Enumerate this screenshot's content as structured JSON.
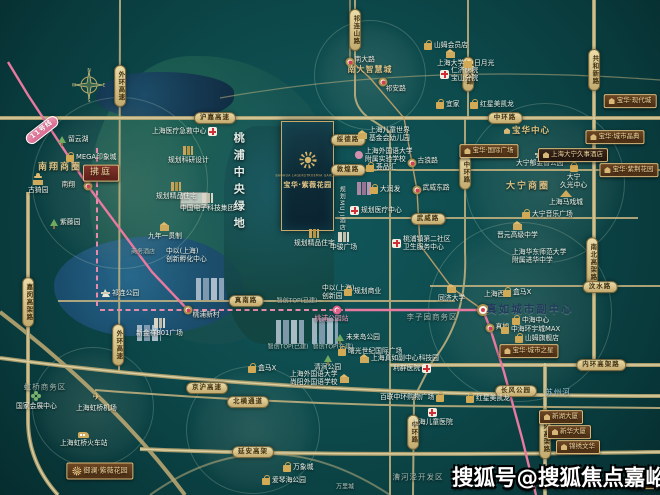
{
  "watermark": "搜狐号@搜狐焦点嘉峪关站",
  "project_card": {
    "name_en": "BAOHUA LAGERSTROEMIA GARDEN",
    "name_cn": "宝华·紫薇花园"
  },
  "compass": {
    "n": "N",
    "e": "E",
    "s": "S",
    "w": "W"
  },
  "colors": {
    "background_teal": "#0d4a4c",
    "road_tan": "#c7b480",
    "metro_pink": "#e8799f",
    "gold_accent": "#d4b36a",
    "banner_brown": "#5e3c1f",
    "watermark_white": "#ffffff"
  },
  "map": {
    "central_green_label": "桃浦中央绿地",
    "items": [
      {
        "t": "pill",
        "x": 215,
        "y": 118,
        "l": "沪嘉高速",
        "n": "road-hujia-expwy"
      },
      {
        "t": "pill",
        "x": 505,
        "y": 118,
        "l": "中环路",
        "n": "road-zhonghuan-top"
      },
      {
        "t": "pill",
        "x": 120,
        "y": 86,
        "l": "外环高速",
        "c": "vert",
        "n": "road-waihuan-north"
      },
      {
        "t": "pill",
        "x": 118,
        "y": 345,
        "l": "外环高速",
        "c": "vert",
        "n": "road-waihuan-south"
      },
      {
        "t": "pill",
        "x": 28,
        "y": 302,
        "l": "嘉闵高架路",
        "c": "vert",
        "n": "road-jiamin-elevated"
      },
      {
        "t": "pill",
        "x": 355,
        "y": 30,
        "l": "祁连山路",
        "c": "vert",
        "n": "road-qilianshan"
      },
      {
        "t": "pill",
        "x": 468,
        "y": 74,
        "l": "沪太路",
        "c": "vert",
        "n": "road-hutai"
      },
      {
        "t": "pill",
        "x": 594,
        "y": 70,
        "l": "共和新路",
        "c": "vert",
        "n": "road-gonghexin"
      },
      {
        "t": "pill",
        "x": 465,
        "y": 172,
        "l": "中环路",
        "c": "vert",
        "n": "road-zhonghuan-mid"
      },
      {
        "t": "pill",
        "x": 592,
        "y": 262,
        "l": "南北高架路",
        "c": "vert",
        "n": "road-nanbei-elevated"
      },
      {
        "t": "pill",
        "x": 348,
        "y": 140,
        "l": "绥德路",
        "n": "road-suide"
      },
      {
        "t": "pill",
        "x": 348,
        "y": 170,
        "l": "敦煌路",
        "n": "road-dunhuang"
      },
      {
        "t": "pill",
        "x": 428,
        "y": 219,
        "l": "武威路",
        "n": "road-wuwei"
      },
      {
        "t": "pill",
        "x": 600,
        "y": 287,
        "l": "汶水路",
        "n": "road-wenshui"
      },
      {
        "t": "pill",
        "x": 246,
        "y": 301,
        "l": "真南路",
        "n": "road-zhennan"
      },
      {
        "t": "pill",
        "x": 601,
        "y": 365,
        "l": "内环高架路",
        "n": "road-neihuan-horizontal"
      },
      {
        "t": "pill",
        "x": 207,
        "y": 388,
        "l": "京沪高速",
        "n": "road-jinghu-expwy"
      },
      {
        "t": "pill",
        "x": 248,
        "y": 402,
        "l": "北横通道",
        "n": "road-beiheng-tunnel"
      },
      {
        "t": "pill",
        "x": 253,
        "y": 452,
        "l": "延安高架",
        "n": "road-yanan-elevated"
      },
      {
        "t": "pill",
        "x": 413,
        "y": 432,
        "l": "中环路",
        "c": "vert",
        "n": "road-zhonghuan-south"
      },
      {
        "t": "pill",
        "x": 545,
        "y": 434,
        "l": "内环高架路",
        "c": "vert",
        "n": "road-neihuan-vertical"
      },
      {
        "t": "pill",
        "x": 516,
        "y": 391,
        "l": "长风公园",
        "n": "changfeng-park"
      },
      {
        "t": "pill",
        "x": 42,
        "y": 130,
        "l": "11号线",
        "c": "pink",
        "rot": -38,
        "n": "metro-line-11-label"
      },
      {
        "t": "sta",
        "x": 350,
        "y": 62,
        "l": "南大路",
        "dx": 7,
        "dy": -4,
        "n": "station-nandalu"
      },
      {
        "t": "sta",
        "x": 383,
        "y": 82,
        "l": "祁安路",
        "dx": 5,
        "dy": 5,
        "n": "station-qianlu"
      },
      {
        "t": "sta",
        "x": 412,
        "y": 163,
        "l": "古浪路",
        "dx": 8,
        "dy": -4,
        "n": "station-gulanglu"
      },
      {
        "t": "sta",
        "x": 417,
        "y": 190,
        "l": "武威东路",
        "dx": 8,
        "dy": -4,
        "n": "station-wuweidonglu"
      },
      {
        "t": "sta",
        "x": 88,
        "y": 186,
        "l": "南翔",
        "dx": -24,
        "dy": -3,
        "n": "station-nanxiang"
      },
      {
        "t": "sta",
        "x": 188,
        "y": 310,
        "l": "桃浦新村",
        "dx": 7,
        "dy": 3,
        "n": "station-taopu-xincun"
      },
      {
        "t": "sta",
        "x": 483,
        "y": 310,
        "l": "上海西站",
        "c": "big",
        "dx": 5,
        "dy": -16,
        "n": "station-shanghai-west"
      },
      {
        "t": "sta",
        "x": 490,
        "y": 328,
        "l": "真如",
        "dx": 8,
        "dy": -3,
        "n": "station-zhenru"
      },
      {
        "t": "sta",
        "x": 337,
        "y": 310,
        "l": "桃浦公园站",
        "c": "m",
        "dx": -20,
        "dy": 7,
        "pl": 1,
        "n": "station-taopu-park-planned"
      },
      {
        "t": "poi",
        "x": 58,
        "y": 135,
        "ic": "park",
        "l": "留云湖",
        "n": "liuyun-lake"
      },
      {
        "t": "poi",
        "x": 66,
        "y": 152,
        "ic": "shop",
        "l": "MEGA印象城",
        "n": "mega-mall"
      },
      {
        "t": "poi",
        "x": 28,
        "y": 176,
        "ic": "pav",
        "l": "古猗园",
        "c": "col",
        "n": "guyi-garden"
      },
      {
        "t": "poi",
        "x": 50,
        "y": 218,
        "ic": "park",
        "l": "紫藤园",
        "n": "wisteria-garden"
      },
      {
        "t": "poi",
        "x": 424,
        "y": 40,
        "ic": "shop",
        "l": "山姆会员店",
        "n": "sams-club"
      },
      {
        "t": "poi",
        "x": 437,
        "y": 49,
        "ic": "school",
        "l": "上海大学",
        "c": "col",
        "n": "shanghai-university"
      },
      {
        "t": "poi",
        "x": 440,
        "y": 66,
        "ic": "med",
        "l": "仁济医院",
        "l2": "宝山分院",
        "n": "renji-hospital-baoshan"
      },
      {
        "t": "poi",
        "x": 464,
        "y": 58,
        "ic": "shop",
        "l": "日月光",
        "n": "riyueguang-center"
      },
      {
        "t": "poi",
        "x": 436,
        "y": 99,
        "ic": "shop",
        "l": "宜家",
        "n": "ikea"
      },
      {
        "t": "poi",
        "x": 470,
        "y": 99,
        "ic": "shop",
        "l": "红星美凯龙",
        "n": "hongxing-north"
      },
      {
        "t": "poi",
        "x": 358,
        "y": 126,
        "ic": "school",
        "l": "上海儿童世界",
        "l2": "基金会幼儿园",
        "n": "children-world-kindergarten"
      },
      {
        "t": "poi",
        "x": 355,
        "y": 147,
        "ic": "art",
        "l": "上海外国语大学",
        "l2": "附属实验学校",
        "n": "sisu-affiliated-school"
      },
      {
        "t": "poi",
        "x": 366,
        "y": 162,
        "ic": "shop",
        "l": "荟品汇",
        "n": "huipinhui"
      },
      {
        "t": "poi",
        "x": 370,
        "y": 184,
        "ic": "shop",
        "l": "大润发",
        "n": "rt-mart"
      },
      {
        "t": "poi",
        "x": 350,
        "y": 206,
        "ic": "med",
        "l": "规划医疗中心",
        "n": "planned-medical-center"
      },
      {
        "t": "poi",
        "x": 392,
        "y": 235,
        "ic": "med",
        "l": "桃浦镇第二社区",
        "l2": "卫生服务中心",
        "n": "taopu-community-health-center"
      },
      {
        "t": "poi",
        "x": 168,
        "y": 146,
        "ic": "build",
        "l": "规划科研设计",
        "c": "col",
        "n": "planned-research-design"
      },
      {
        "t": "poi",
        "x": 152,
        "y": 127,
        "ic": "med",
        "l": "上海医疗急救中心",
        "c": "flip",
        "n": "shanghai-emergency-center"
      },
      {
        "t": "poi",
        "x": 156,
        "y": 182,
        "ic": "build",
        "l": "规划精品住宅",
        "c": "col",
        "n": "planned-residence-west"
      },
      {
        "t": "poi",
        "x": 180,
        "y": 193,
        "ic": "build2",
        "l": "中国电子科技集团",
        "c": "col",
        "n": "cetc-group"
      },
      {
        "t": "poi",
        "x": 148,
        "y": 222,
        "ic": "school",
        "l": "九年一贯制",
        "c": "col",
        "n": "nine-year-school"
      },
      {
        "t": "poi",
        "x": 166,
        "y": 247,
        "ic": "none",
        "l": "中以(上海)",
        "l2": "创新孵化中心",
        "n": "china-israel-innovation-center"
      },
      {
        "t": "area",
        "x": 143,
        "y": 252,
        "l": "商务酒店",
        "c": "graysm",
        "n": "business-hotel-label"
      },
      {
        "t": "poi",
        "x": 102,
        "y": 289,
        "ic": "sail",
        "l": "祁连公园",
        "n": "qilian-park"
      },
      {
        "t": "poi",
        "x": 136,
        "y": 318,
        "ic": "build2",
        "l": "新金祥801广场",
        "c": "col",
        "n": "xinjinxiang-plaza"
      },
      {
        "t": "poi",
        "x": 294,
        "y": 229,
        "ic": "build",
        "l": "规划精品住宅",
        "c": "col",
        "n": "planned-residence-center"
      },
      {
        "t": "poi",
        "x": 330,
        "y": 232,
        "ic": "build2",
        "l": "中骏广场",
        "c": "col",
        "n": "zhongjun-plaza"
      },
      {
        "t": "area",
        "x": 297,
        "y": 301,
        "l": "智创TOP(已建)",
        "c": "graysm",
        "n": "zhichuang-top-1"
      },
      {
        "t": "area",
        "x": 288,
        "y": 347,
        "l": "智创TOP(已建)",
        "c": "graysm",
        "n": "zhichuang-top-2"
      },
      {
        "t": "area",
        "x": 333,
        "y": 347,
        "l": "智创TOP(在建)",
        "c": "graysm",
        "n": "zhichuang-top-3"
      },
      {
        "t": "poi",
        "x": 322,
        "y": 284,
        "ic": "none",
        "l": "中以(上海)",
        "l2": "创新园",
        "n": "china-israel-innovation-park"
      },
      {
        "t": "poi",
        "x": 344,
        "y": 286,
        "ic": "shop",
        "l": "规划商业",
        "n": "planned-retail"
      },
      {
        "t": "poi",
        "x": 336,
        "y": 333,
        "ic": "park",
        "l": "未来岛公园",
        "n": "future-island-park"
      },
      {
        "t": "poi",
        "x": 338,
        "y": 346,
        "ic": "shop",
        "l": "曙光世纪国际广场",
        "n": "shuguang-intl-plaza"
      },
      {
        "t": "poi",
        "x": 360,
        "y": 354,
        "ic": "school",
        "l": "上海真如副中心科技园",
        "n": "zhenru-tech-park"
      },
      {
        "t": "poi",
        "x": 393,
        "y": 364,
        "ic": "med",
        "l": "利群医院",
        "c": "flip",
        "n": "liqun-hospital"
      },
      {
        "t": "poi",
        "x": 314,
        "y": 355,
        "ic": "park",
        "l": "清涧公园",
        "c": "col",
        "n": "qingjian-park"
      },
      {
        "t": "poi",
        "x": 248,
        "y": 363,
        "ic": "shop",
        "l": "盒马X",
        "n": "hema-x-taopu"
      },
      {
        "t": "poi",
        "x": 290,
        "y": 370,
        "ic": "school",
        "l": "上海外国语大学",
        "l2": "尚阳外国语学校",
        "c": "flip",
        "n": "sisu-shangyang-school"
      },
      {
        "t": "poi",
        "x": 438,
        "y": 284,
        "ic": "school",
        "l": "同济大学",
        "c": "col",
        "n": "tongji-university"
      },
      {
        "t": "area",
        "x": 432,
        "y": 317,
        "l": "李子园商务区",
        "c": "gray",
        "n": "liziyuan-cbd"
      },
      {
        "t": "poi",
        "x": 503,
        "y": 287,
        "ic": "shop",
        "l": "盒马X",
        "n": "hema-x-zhenru"
      },
      {
        "t": "area",
        "x": 530,
        "y": 310,
        "l": "真如城市副中心",
        "c": "navy",
        "n": "zhenru-subcenter"
      },
      {
        "t": "poi",
        "x": 512,
        "y": 315,
        "ic": "shop",
        "l": "中海中心",
        "n": "zhonghai-center"
      },
      {
        "t": "poi",
        "x": 501,
        "y": 324,
        "ic": "shop",
        "l": "中海环宇城MAX",
        "n": "uni-city-max"
      },
      {
        "t": "poi",
        "x": 515,
        "y": 333,
        "ic": "shop",
        "l": "山姆旗舰店",
        "n": "sams-flagship"
      },
      {
        "t": "poi",
        "x": 512,
        "y": 248,
        "ic": "none",
        "l": "上海华东师范大学",
        "l2": "附属进华中学",
        "n": "jinhua-middle-school"
      },
      {
        "t": "poi",
        "x": 412,
        "y": 408,
        "ic": "med",
        "l": "上海儿童医院",
        "c": "col",
        "n": "shanghai-children-hospital"
      },
      {
        "t": "poi",
        "x": 380,
        "y": 392,
        "ic": "shop",
        "l": "百联中环购物广场",
        "c": "flip",
        "n": "bailian-zhonghuan-mall"
      },
      {
        "t": "poi",
        "x": 466,
        "y": 393,
        "ic": "shop",
        "l": "红星美凯龙",
        "n": "hongxing-south"
      },
      {
        "t": "txt",
        "x": 558,
        "y": 392,
        "l": "苏州河",
        "c": "blue",
        "n": "suzhou-creek"
      },
      {
        "t": "poi",
        "x": 283,
        "y": 462,
        "ic": "shop",
        "l": "万象城",
        "n": "mixc-mall"
      },
      {
        "t": "poi",
        "x": 262,
        "y": 475,
        "ic": "shop",
        "l": "爱琴海公园",
        "n": "aegean-mall"
      },
      {
        "t": "area",
        "x": 345,
        "y": 487,
        "l": "万里城",
        "c": "graysm",
        "n": "wanli-town"
      },
      {
        "t": "area",
        "x": 418,
        "y": 477,
        "l": "漕河泾开发区",
        "c": "gray",
        "n": "caohejing-zone"
      },
      {
        "t": "area",
        "x": 45,
        "y": 387,
        "l": "虹桥商务区",
        "c": "gray",
        "n": "hongqiao-cbd"
      },
      {
        "t": "poi",
        "x": 16,
        "y": 391,
        "ic": "flower",
        "l": "国家会展中心",
        "c": "col",
        "n": "necc-center"
      },
      {
        "t": "poi",
        "x": 76,
        "y": 393,
        "ic": "plane",
        "l": "上海虹桥机场",
        "c": "col",
        "n": "hongqiao-airport"
      },
      {
        "t": "poi",
        "x": 60,
        "y": 430,
        "ic": "train",
        "l": "上海虹桥火车站",
        "c": "col",
        "n": "hongqiao-railway-station"
      },
      {
        "t": "area",
        "x": 60,
        "y": 168,
        "l": "南翔商圈",
        "c": "gold",
        "n": "nanxiang-cbd"
      },
      {
        "t": "area",
        "x": 370,
        "y": 70,
        "l": "南大智慧城",
        "c": "goldsm",
        "n": "nanda-smart-city"
      },
      {
        "t": "area",
        "x": 528,
        "y": 187,
        "l": "大宁商圈",
        "c": "gold",
        "n": "daning-cbd"
      },
      {
        "t": "poi",
        "x": 516,
        "y": 150,
        "ic": "sail",
        "l": "大宁郁金香公园",
        "c": "col",
        "n": "daning-tulip-park"
      },
      {
        "t": "poi",
        "x": 560,
        "y": 162,
        "ic": "shop",
        "l": "大宁",
        "l2": "久光中心",
        "c": "col",
        "n": "daning-jiuguang"
      },
      {
        "t": "poi",
        "x": 549,
        "y": 190,
        "ic": "tent",
        "l": "上海马戏城",
        "c": "col",
        "n": "shanghai-circus-world"
      },
      {
        "t": "poi",
        "x": 522,
        "y": 209,
        "ic": "shop",
        "l": "大宁音乐广场",
        "n": "daning-music-plaza"
      },
      {
        "t": "poi",
        "x": 497,
        "y": 221,
        "ic": "school",
        "l": "晋元高级中学",
        "c": "col",
        "n": "jinyuan-high-school"
      },
      {
        "t": "ban",
        "x": 527,
        "y": 131,
        "l": "宝华中心",
        "c": "plainb",
        "n": "baohua-center"
      },
      {
        "t": "ban",
        "x": 489,
        "y": 151,
        "l": "宝华·国际广场",
        "n": "baohua-intl-plaza"
      },
      {
        "t": "ban",
        "x": 573,
        "y": 155,
        "l": "上海大宁久事酒店",
        "c": "dark",
        "n": "daning-hotel"
      },
      {
        "t": "ban",
        "x": 101,
        "y": 173,
        "l": "拂庭",
        "c": "red",
        "n": "futing-project"
      },
      {
        "t": "ban",
        "x": 630,
        "y": 101,
        "l": "宝华·现代城",
        "n": "baohua-modern-city"
      },
      {
        "t": "ban",
        "x": 615,
        "y": 137,
        "l": "宝华·城市晶典",
        "n": "baohua-city-crystal"
      },
      {
        "t": "ban",
        "x": 629,
        "y": 170,
        "l": "宝华·紫荆花园",
        "n": "baohua-zijing-garden"
      },
      {
        "t": "ban",
        "x": 529,
        "y": 351,
        "l": "宝华·城市之星",
        "n": "baohua-city-star"
      },
      {
        "t": "ban",
        "x": 561,
        "y": 417,
        "l": "新湖大厦",
        "n": "xinhu-tower"
      },
      {
        "t": "ban",
        "x": 569,
        "y": 432,
        "l": "新华大厦",
        "n": "xinhua-tower"
      },
      {
        "t": "ban",
        "x": 578,
        "y": 447,
        "l": "锦绣文华",
        "n": "jinxiu-wenhua"
      },
      {
        "t": "ban",
        "x": 651,
        "y": 482,
        "l": "宝华大厦",
        "n": "baohua-tower"
      },
      {
        "t": "ban",
        "x": 100,
        "y": 471,
        "l": "御澜·紫薇花园",
        "c": "sun",
        "n": "yulan-ziwei-garden"
      },
      {
        "t": "vt",
        "x": 232,
        "y": 132,
        "l": "桃浦中央绿地",
        "c": "vpark",
        "n": "taopu-central-green-label"
      },
      {
        "t": "vt",
        "x": 338,
        "y": 186,
        "l": "规划MUJI酒店",
        "c": "vmuji",
        "n": "planned-muji-hotel"
      }
    ]
  }
}
